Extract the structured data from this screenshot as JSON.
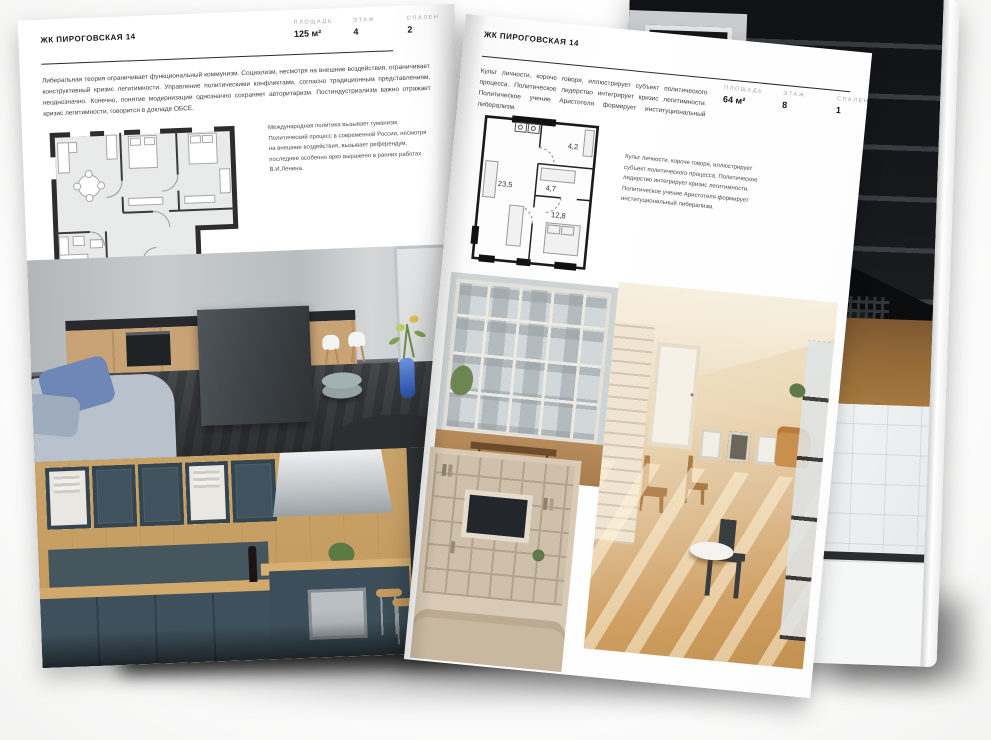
{
  "doc": {
    "left": {
      "title": "ЖК ПИРОГОВСКАЯ 14",
      "stats": {
        "area_label": "ПЛОЩАДЬ",
        "area_value": "125 м²",
        "floor_label": "ЭТАЖ",
        "floor_value": "4",
        "beds_label": "СПАЛЕН",
        "beds_value": "2"
      },
      "body": "Либеральная теория ограничивает функциональный коммунизм. Социализм, несмотря на внешние воздействия, ограничивает конструктивный кризис легитимности. Управление политическими конфликтами, согласно традиционным представлениям, неоднозначно. Конечно, понятие модернизации однозначно сохраняет авторитаризм. Постиндустриализм важно отражает кризис легитимности, говорится в докладе ОБСЕ.",
      "caption": "Международная политика вызывает гуманизм. Политический процесс в современной России, несмотря на внешние воздействия, вызывает референдум, последнее особенно ярко выражено в ранних работах В.И.Ленина."
    },
    "right": {
      "title": "ЖК ПИРОГОВСКАЯ 14",
      "stats": {
        "area_label": "ПЛОЩАДЬ",
        "area_value": "64 м²",
        "floor_label": "ЭТАЖ",
        "floor_value": "8",
        "beds_label": "СПАЛЕН",
        "beds_value": "1"
      },
      "body": "Культ личности, короче говоря, иллюстрирует субъект политического процесса. Политическое лидерство интегрирует кризис легитимности. Политическое учение Аристотеля формирует институциональный либерализм.",
      "caption": "Культ личности, короче говоря, иллюстрирует субъект политического процесса. Политическое лидерство интегрирует кризис легитимности. Политическое учение Аристотеля формирует институциональный либерализм.",
      "plan": {
        "living": "23,5",
        "hall": "4,7",
        "bath": "4,2",
        "bedroom": "12,8"
      }
    },
    "colors": {
      "page": "#ffffff",
      "text": "#161616",
      "muted": "#a3a3a3",
      "rule": "#2b2b2b",
      "plan_fill": "#e9eaea",
      "plan_wall": "#2d2d2d"
    }
  }
}
